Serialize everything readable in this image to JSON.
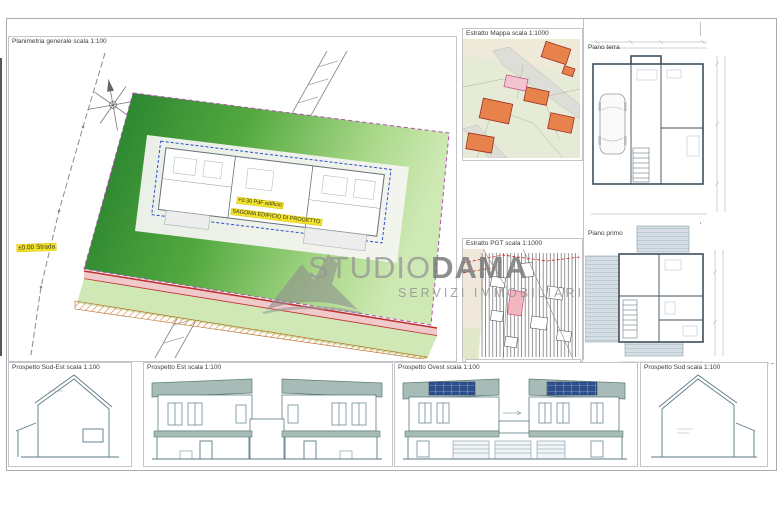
{
  "sheet": {
    "type": "architectural-drawing-sheet",
    "background": "#ffffff"
  },
  "panels": {
    "planimetria": {
      "title": "Planimetria generale scala 1:100"
    },
    "estratto_mappa": {
      "title": "Estratto Mappa scala 1:1000"
    },
    "estratto_pgt": {
      "title": "Estratto PGT scala 1:1000"
    },
    "piano_terra": {
      "title": "Piano terra"
    },
    "piano_primo": {
      "title": "Piano primo"
    },
    "prospetto_sud_est": {
      "title": "Prospetto Sud-Est scala 1:100"
    },
    "prospetto_est": {
      "title": "Prospetto Est scala 1:100"
    },
    "prospetto_ovest": {
      "title": "Prospetto Ovest scala 1:100"
    },
    "prospetto_sud": {
      "title": "Prospetto Sud scala 1:100"
    }
  },
  "labels": {
    "quota_strada": "±0.00 Strada",
    "quota_edificio": "+0.30 PdF edificio",
    "sagoma": "SAGOMA EDIFICIO DI PROGETTO"
  },
  "watermark": {
    "studio": "STUDIO",
    "dama": "DAMA",
    "subtitle": "SERVIZI IMMOBILIARI"
  },
  "icons": {
    "compass": "compass-rose-icon",
    "logo": "studiodama-logo-icon"
  },
  "colors": {
    "parcel_green_dark": "#1f7a2b",
    "parcel_green_light": "#cfe9b5",
    "stripe_red": "#c03030",
    "hatch_orange": "#e0762a",
    "highlight_yellow": "#f2e32b",
    "boundary_magenta": "#b050b0",
    "building_outline_blue": "#2b4fd0",
    "roof_teal": "#a7bcb6",
    "solar_panel_blue": "#2e4e8c",
    "map_building_orange": "#e8824c",
    "map_building_pink": "#f3c3d2",
    "pgt_pink": "#f2b6c0",
    "watermark_gray": "#9b9b9b"
  }
}
